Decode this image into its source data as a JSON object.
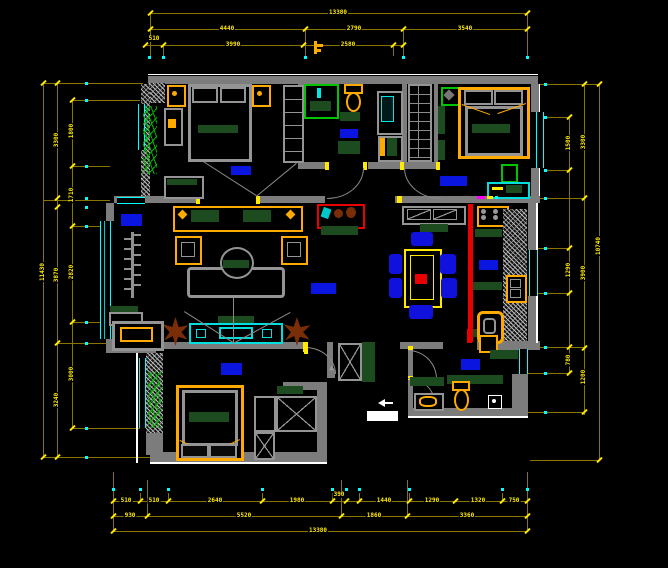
{
  "canvas": {
    "width": 668,
    "height": 568,
    "background": "#000000",
    "type": "cad-floor-plan"
  },
  "palette": {
    "wall_gray": "#7c7c7c",
    "dimension_yellow": "#ffe900",
    "dimension_line_olive": "#8a7400",
    "window_cyan": "#00ffff",
    "room_label_blue": "#0a16e0",
    "furniture_green": "#1d4b20",
    "furniture_orange": "#ffaa00",
    "accent_red": "#e90000",
    "plant_green": "#00b400",
    "chair_blue": "#1111dd",
    "plant_brown": "#7a2e08",
    "white": "#ffffff"
  },
  "dims": {
    "top": {
      "total": "13380",
      "row2": [
        "4440",
        "2790",
        "3540"
      ],
      "row3": [
        "510",
        "3990",
        "2580"
      ]
    },
    "bottom": {
      "row1": [
        "510",
        "510",
        "2640",
        "1980",
        "390",
        "1440",
        "1290",
        "1320",
        "750"
      ],
      "row2": [
        "930",
        "5520",
        "1860",
        "3360"
      ],
      "total": "13380"
    },
    "left": {
      "outer": "11430",
      "mid": [
        "3300",
        "3870",
        "3240"
      ],
      "inner": [
        "1800",
        "1710",
        "2820",
        "3000"
      ]
    },
    "right": {
      "outer": "10740",
      "mid": [
        "3300",
        "3900",
        "1200"
      ],
      "inner": [
        "1500",
        "1290",
        "780"
      ]
    }
  },
  "rooms": [
    {
      "id": "bedroom-top-left"
    },
    {
      "id": "bathroom-top"
    },
    {
      "id": "bedroom-top-right"
    },
    {
      "id": "living-room-west"
    },
    {
      "id": "living-room-center"
    },
    {
      "id": "kitchen"
    },
    {
      "id": "bedroom-bottom-left"
    },
    {
      "id": "bathroom-bottom-right"
    }
  ],
  "icons": [
    "shower-icon",
    "toilet-icon",
    "ceiling-fan-icon",
    "plant-icon",
    "paper-holder-icon",
    "pointer-icon",
    "radiator-icon",
    "stove-icon",
    "sink-icon"
  ]
}
